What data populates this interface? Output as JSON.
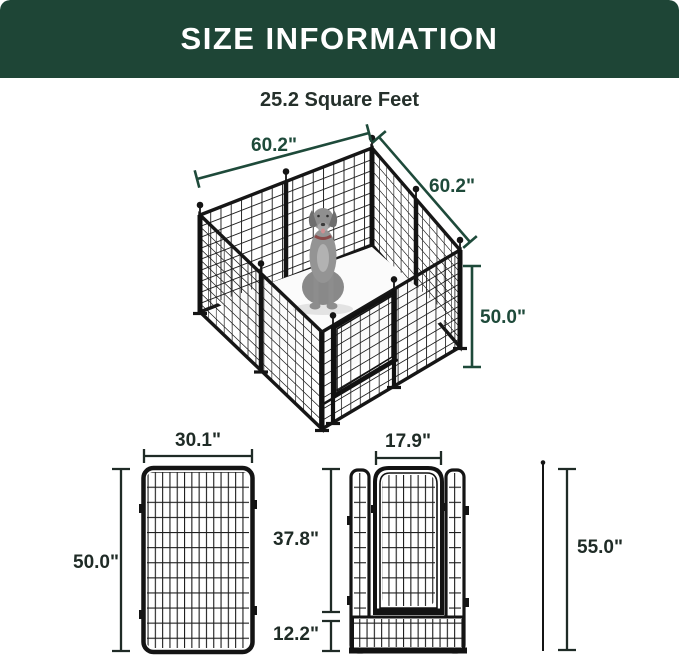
{
  "header": {
    "title": "SIZE INFORMATION"
  },
  "area": {
    "label": "25.2 Square Feet"
  },
  "main_diagram": {
    "description": "isometric 8-panel metal dog playpen with dog inside",
    "dim_side_left": "60.2\"",
    "dim_side_right": "60.2\"",
    "dim_height": "50.0\""
  },
  "single_panel_diagram": {
    "dim_width": "30.1\"",
    "dim_height": "50.0\""
  },
  "door_panel_diagram": {
    "dim_door_width": "17.9\"",
    "dim_door_height": "37.8\"",
    "dim_bottom_height": "12.2\""
  },
  "ground_stake_diagram": {
    "dim_height": "55.0\""
  },
  "colors": {
    "header_bg": "#1e4536",
    "dimension_green": "#1e4a3a",
    "dimension_black": "#1f2b26",
    "fence": "#161616",
    "dog_gray": "#8e8e8e"
  }
}
